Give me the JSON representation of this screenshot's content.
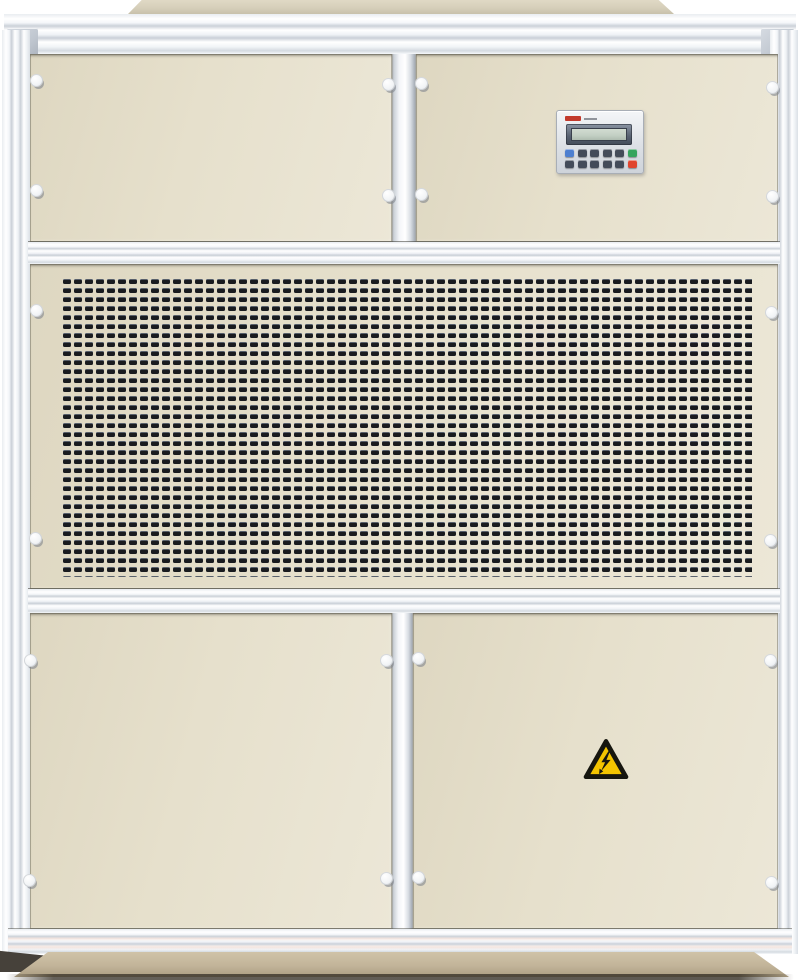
{
  "scene": {
    "description": "Front-view photograph of a beige industrial air-handling / dehumidifier cabinet with silver aluminium framing, a central perforated ventilation grille, a small controller keypad on the upper-right panel, an electrical-hazard warning sticker on the lower-right door, and a tan base plinth.",
    "background_color": "#ffffff"
  },
  "cabinet": {
    "frame_color": "#f4f6f9",
    "panel_color": "#e6e0cc",
    "panel_color_dark": "#ded7c1",
    "plinth_color": "#c2b499",
    "panels": [
      {
        "id": "top-left",
        "type": "blank-access-panel"
      },
      {
        "id": "top-right",
        "type": "controller-panel"
      },
      {
        "id": "middle",
        "type": "ventilation-grille-panel"
      },
      {
        "id": "bottom-left",
        "type": "blank-access-door"
      },
      {
        "id": "bottom-right",
        "type": "hazard-access-door"
      }
    ]
  },
  "grille": {
    "x": 62,
    "y": 277,
    "w": 690,
    "h": 300,
    "pitch_x": 11,
    "pitch_y": 9,
    "slot_w": 8,
    "slot_h": 5,
    "slot_color": "#191b1f",
    "slot_highlight": "#5c6c86"
  },
  "latches": [
    {
      "x": 36,
      "y": 80
    },
    {
      "x": 36,
      "y": 190
    },
    {
      "x": 388,
      "y": 84
    },
    {
      "x": 388,
      "y": 195
    },
    {
      "x": 421,
      "y": 83
    },
    {
      "x": 421,
      "y": 194
    },
    {
      "x": 772,
      "y": 87
    },
    {
      "x": 772,
      "y": 196
    },
    {
      "x": 36,
      "y": 310
    },
    {
      "x": 35,
      "y": 538
    },
    {
      "x": 771,
      "y": 312
    },
    {
      "x": 770,
      "y": 540
    },
    {
      "x": 30,
      "y": 660
    },
    {
      "x": 29,
      "y": 880
    },
    {
      "x": 386,
      "y": 660
    },
    {
      "x": 386,
      "y": 878
    },
    {
      "x": 418,
      "y": 658
    },
    {
      "x": 418,
      "y": 877
    },
    {
      "x": 770,
      "y": 660
    },
    {
      "x": 771,
      "y": 882
    }
  ],
  "control_panel": {
    "brand_mark_color": "#c23a2c",
    "lcd_bezel_color": "#566070",
    "lcd_screen_color": "#c2cfc3",
    "button_rows": [
      [
        "blue",
        "dark",
        "dark",
        "dark",
        "dark",
        "green"
      ],
      [
        "dark",
        "dark",
        "dark",
        "dark",
        "dark",
        "red"
      ]
    ],
    "button_colors": {
      "blue": "#4d7fd0",
      "dark": "#434b59",
      "green": "#36a45e",
      "red": "#e0442e"
    }
  },
  "hazard_sticker": {
    "icon": "electrical-hazard-icon",
    "triangle_color": "#f3c400",
    "symbol_color": "#16160f"
  }
}
